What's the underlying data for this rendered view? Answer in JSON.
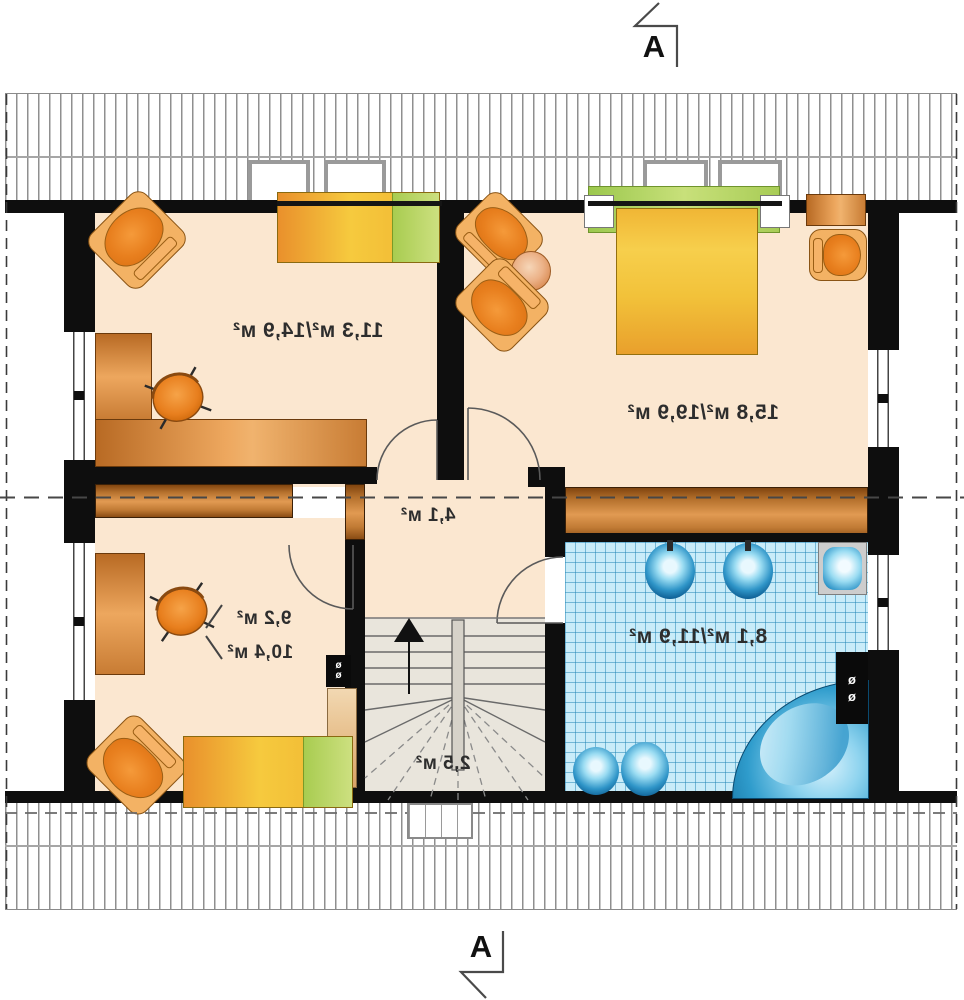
{
  "title": "attic floor plan",
  "section_markers": {
    "top_label": "A",
    "bottom_label": "A"
  },
  "rooms": {
    "bedroom_top_left": {
      "area": "11,3 м²/14,9 м²"
    },
    "bedroom_top_right": {
      "area": "15,8 м²/19,9 м²"
    },
    "hall": {
      "area": "4,1 м²"
    },
    "bedroom_bottom_left": {
      "area_line1": "9,2 м²",
      "area_line2": "10,4 м²"
    },
    "bathroom": {
      "area": "8,1 м²/11,9 м²"
    },
    "staircase": {
      "area": "2,5 м²"
    }
  },
  "symbols": {
    "flue": "ø"
  },
  "colors": {
    "floor_peach": "#fbe7d0",
    "wall_black": "#0e0e0e",
    "wood_brown": "#b4702c",
    "bed_yellow": "#f6ca3e",
    "pillow_green": "#c2da68",
    "tile_blue": "#c9ecf9",
    "fixture_blue": "#2f95c8",
    "stair_gray": "#e9e5dc",
    "hatch_gray": "#8f8f8f"
  }
}
